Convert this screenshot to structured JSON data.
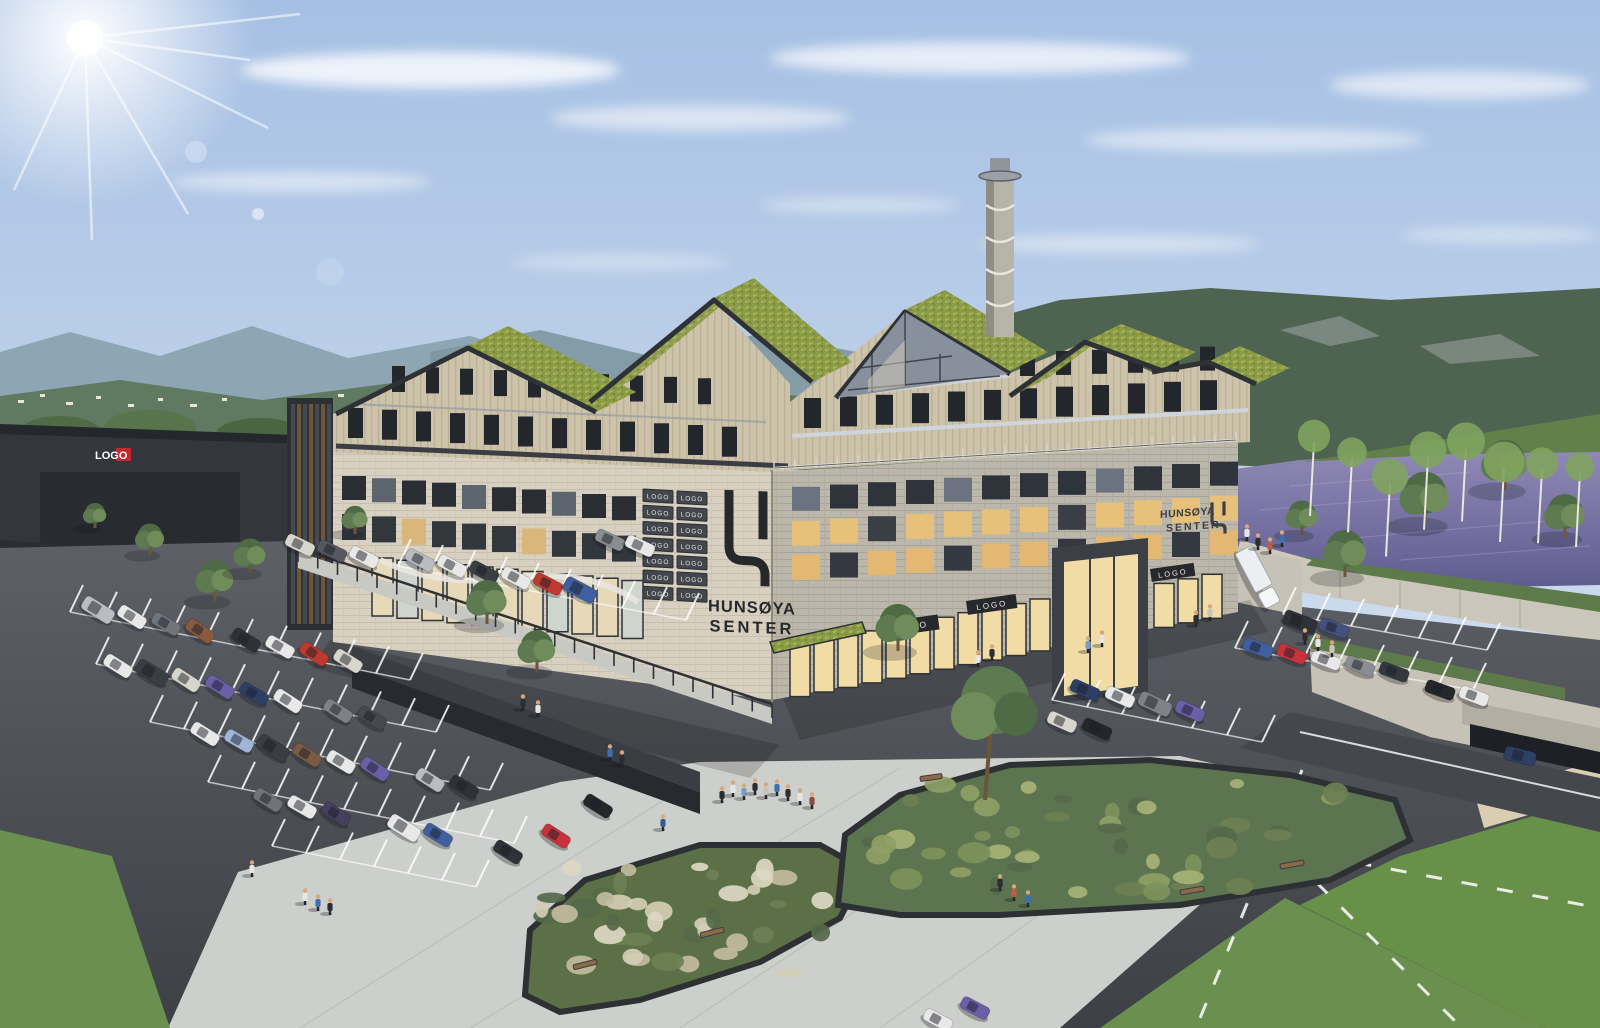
{
  "scene": {
    "name": "hunsoya-senter-aerial-rendering",
    "description": "Aerial architectural rendering of the Hunsøya Senter mixed-use centre with green sedum roofs, spiral chimney tower, large parking lot, plaza with planters, river and forested hills"
  },
  "branding": {
    "main_sign_line1": "HUNSØYA",
    "main_sign_line2": "SENTER",
    "side_sign_line1": "HUNSØYA",
    "side_sign_line2": "SENTER"
  },
  "signs": {
    "logo_grid": [
      "LOGO",
      "LOGO",
      "LOGO",
      "LOGO",
      "LOGO",
      "LOGO",
      "LOGO",
      "LOGO",
      "LOGO",
      "LOGO",
      "LOGO",
      "LOGO",
      "LOGO",
      "LOGO"
    ],
    "storefront": [
      "LOGO",
      "LOGO",
      "LOGO"
    ],
    "warehouse": "LOGO"
  },
  "palette": {
    "sky_top": "#a6c0e4",
    "sky_horizon": "#ecf1f7",
    "sedum_roof": "#8a9a45",
    "wood_facade": "#cdc3ab",
    "stone_light": "#d8d1c2",
    "stone_grey": "#bcb7ab",
    "asphalt": "#4a4d52",
    "plaza": "#cdcfcc",
    "water": "#716d9e",
    "forest": "#4e6350",
    "grass": "#6a8f4e",
    "sign_plate": "#43464c",
    "logo_ink": "#26282a",
    "warehouse_red": "#c5272d"
  },
  "parking": {
    "cars": [
      [
        98,
        610,
        32,
        "#b9bcc0"
      ],
      [
        132,
        617,
        32,
        "#e8e8e8"
      ],
      [
        166,
        624,
        30,
        "#70757c"
      ],
      [
        200,
        631,
        34,
        "#8a5a3e"
      ],
      [
        246,
        640,
        32,
        "#2e3238"
      ],
      [
        280,
        647,
        30,
        "#e8e8e8"
      ],
      [
        314,
        654,
        33,
        "#c0392f"
      ],
      [
        348,
        661,
        32,
        "#d8d5cf"
      ],
      [
        118,
        666,
        32,
        "#e8e8e8"
      ],
      [
        152,
        673,
        31,
        "#3a3d42"
      ],
      [
        186,
        680,
        33,
        "#d8d5cf"
      ],
      [
        220,
        687,
        32,
        "#6b5fa8"
      ],
      [
        254,
        694,
        30,
        "#2e3f66"
      ],
      [
        288,
        701,
        33,
        "#e8e8e8"
      ],
      [
        338,
        711,
        32,
        "#7e8288"
      ],
      [
        372,
        718,
        31,
        "#464a50"
      ],
      [
        205,
        734,
        32,
        "#e8e8e8"
      ],
      [
        239,
        741,
        30,
        "#9fb6d8"
      ],
      [
        273,
        748,
        33,
        "#3a3d42"
      ],
      [
        307,
        755,
        32,
        "#7a5a42"
      ],
      [
        341,
        762,
        31,
        "#e8e8e8"
      ],
      [
        375,
        769,
        33,
        "#6b5fa8"
      ],
      [
        430,
        780,
        32,
        "#b9bcc0"
      ],
      [
        464,
        787,
        31,
        "#2e3238"
      ],
      [
        268,
        800,
        32,
        "#6f747b"
      ],
      [
        302,
        807,
        30,
        "#e8e8e8"
      ],
      [
        336,
        814,
        33,
        "#46405e"
      ],
      [
        404,
        828,
        32,
        "#e8e8e8"
      ],
      [
        438,
        835,
        31,
        "#3f5f9e"
      ],
      [
        556,
        836,
        33,
        "#c8333b"
      ],
      [
        598,
        806,
        32,
        "#24262a"
      ],
      [
        508,
        852,
        32,
        "#2e3238"
      ],
      [
        975,
        1008,
        28,
        "#6b5fa8"
      ],
      [
        938,
        1020,
        28,
        "#e8e8e8"
      ],
      [
        1085,
        690,
        24,
        "#2e3f66"
      ],
      [
        1120,
        697,
        24,
        "#e8e8e8"
      ],
      [
        1155,
        704,
        25,
        "#7e8288"
      ],
      [
        1190,
        711,
        24,
        "#6b5fa8"
      ],
      [
        1062,
        722,
        24,
        "#d8d5cf"
      ],
      [
        1097,
        729,
        25,
        "#24262a"
      ],
      [
        1258,
        648,
        20,
        "#3f5f9e"
      ],
      [
        1292,
        654,
        22,
        "#c8333b"
      ],
      [
        1326,
        660,
        21,
        "#e8e8e8"
      ],
      [
        1360,
        666,
        22,
        "#8a8d92"
      ],
      [
        1394,
        672,
        20,
        "#35383e"
      ],
      [
        1300,
        622,
        21,
        "#2e3238"
      ],
      [
        1334,
        628,
        20,
        "#46507e"
      ],
      [
        1440,
        690,
        20,
        "#24262a"
      ],
      [
        1474,
        696,
        21,
        "#e8e8e8"
      ],
      [
        420,
        560,
        28,
        "#b9bcc0"
      ],
      [
        452,
        566,
        28,
        "#e8e8e8"
      ],
      [
        484,
        572,
        28,
        "#3a3d42"
      ],
      [
        516,
        578,
        28,
        "#e8e8e8"
      ],
      [
        548,
        584,
        28,
        "#c0392f"
      ],
      [
        580,
        590,
        28,
        "#3f5f9e"
      ],
      [
        300,
        545,
        26,
        "#d8d5cf"
      ],
      [
        332,
        551,
        26,
        "#55585e"
      ],
      [
        364,
        557,
        27,
        "#e8e8e8"
      ],
      [
        610,
        540,
        25,
        "#8a8d92"
      ],
      [
        640,
        546,
        25,
        "#e8e8e8"
      ]
    ],
    "ramp_car": {
      "x": 1520,
      "y": 756,
      "rot": 14,
      "color": "#2e3f66"
    },
    "truck": {
      "x": 1258,
      "y": 578,
      "rot": 62,
      "color": "#eceff1"
    }
  }
}
